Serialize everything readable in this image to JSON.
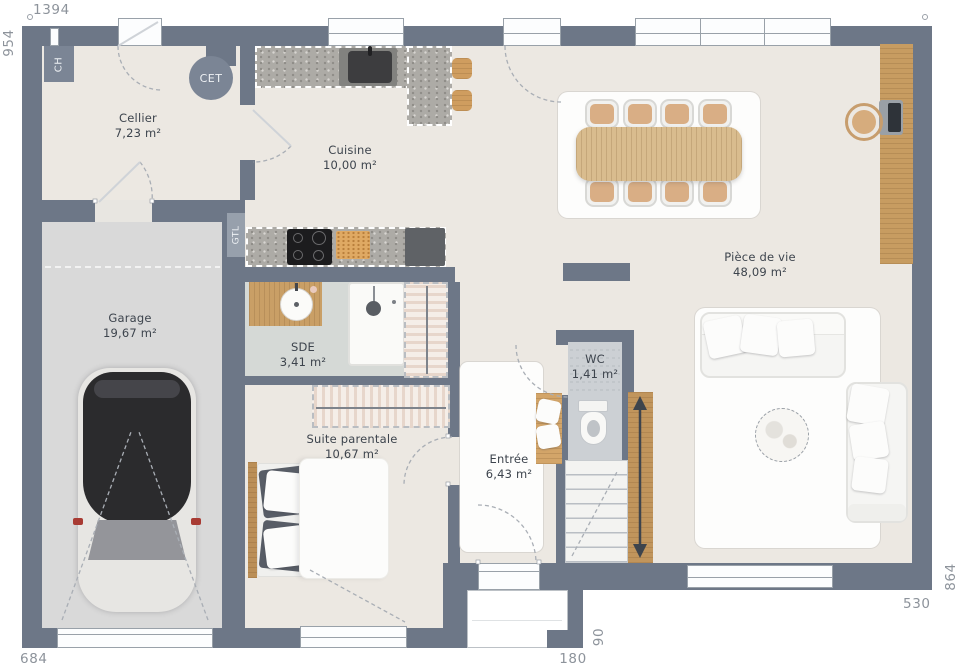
{
  "plan": {
    "dimensions": {
      "width_top": "1394",
      "height_left": "954",
      "garage_width": "684",
      "porch_width": "180",
      "porch_depth": "90",
      "living_width": "530",
      "height_right": "864"
    },
    "rooms": {
      "cellier": {
        "name": "Cellier",
        "area": "7,23 m²"
      },
      "cuisine": {
        "name": "Cuisine",
        "area": "10,00 m²"
      },
      "garage": {
        "name": "Garage",
        "area": "19,67 m²"
      },
      "sde": {
        "name": "SDE",
        "area": "3,41 m²"
      },
      "suite_parentale": {
        "name": "Suite parentale",
        "area": "10,67 m²"
      },
      "entree": {
        "name": "Entrée",
        "area": "6,43 m²"
      },
      "wc": {
        "name": "WC",
        "area": "1,41 m²"
      },
      "piece_de_vie": {
        "name": "Pièce de vie",
        "area": "48,09 m²"
      }
    },
    "annotations": {
      "ch": "CH",
      "cet": "CET",
      "gtl": "GTL"
    },
    "colors": {
      "wall": "#6d7787",
      "floor": "#ece8e2",
      "garage_floor": "#d9d9d9",
      "sde_floor": "#d5d9d6",
      "wc_floor": "#ccd0d4",
      "wood": "#c99f66",
      "counter": "#adaba6",
      "car_body": "#2b2b2d",
      "dim_text": "#8d939b",
      "label_text": "#3d444d"
    }
  }
}
